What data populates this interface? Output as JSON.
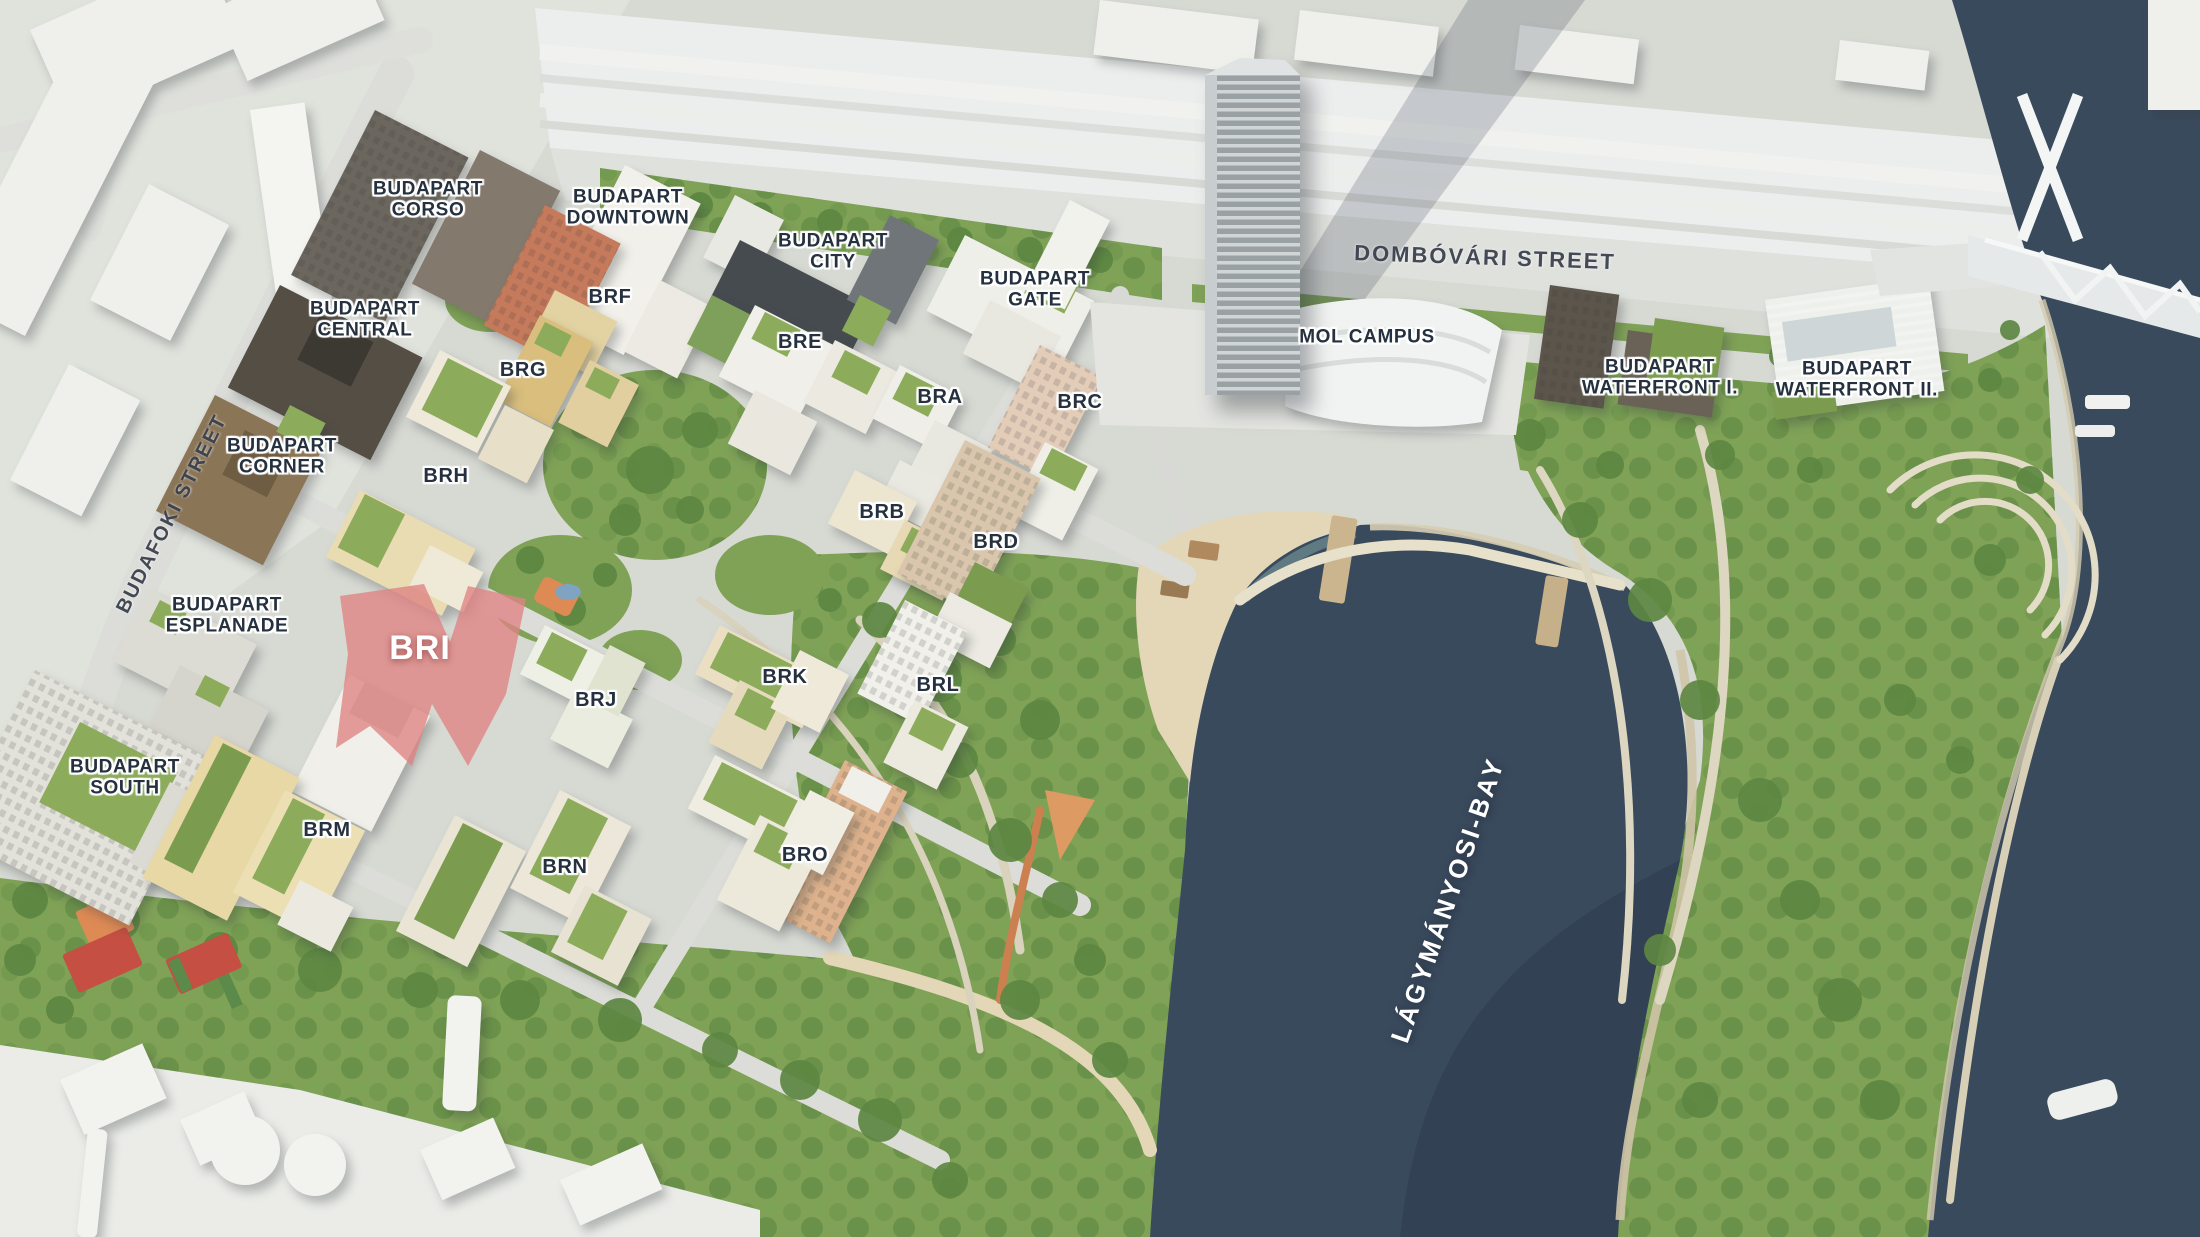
{
  "map_title": "BudaPart development aerial masterplan",
  "colors": {
    "water": "#3a4a5d",
    "water_deep": "#2d3b4c",
    "park": "#7fa257",
    "park_dark": "#557e3b",
    "land": "#d7d9d3",
    "white_zone": "#e7e8e4",
    "corridor": "#eceded",
    "road": "#dcddd9",
    "sand": "#e3d7b8",
    "roof_green": "#8cab5b",
    "ink": "#26313f",
    "label_outline": "#ffffff",
    "highlight": "#df8383",
    "court_red": "#c44f42",
    "court_orange": "#dd8a55"
  },
  "highlighted_building": {
    "code": "BRI",
    "highlight_color": "#df8383"
  },
  "labels": [
    {
      "id": "budapart-corso",
      "text": "BUDAPART\nCORSO",
      "x": 428,
      "y": 200,
      "style": "district"
    },
    {
      "id": "budapart-downtown",
      "text": "BUDAPART\nDOWNTOWN",
      "x": 628,
      "y": 208,
      "style": "district"
    },
    {
      "id": "budapart-city",
      "text": "BUDAPART\nCITY",
      "x": 833,
      "y": 252,
      "style": "district"
    },
    {
      "id": "budapart-gate",
      "text": "BUDAPART\nGATE",
      "x": 1035,
      "y": 290,
      "style": "district"
    },
    {
      "id": "budapart-central",
      "text": "BUDAPART\nCENTRAL",
      "x": 365,
      "y": 320,
      "style": "district"
    },
    {
      "id": "budapart-corner",
      "text": "BUDAPART\nCORNER",
      "x": 282,
      "y": 457,
      "style": "district"
    },
    {
      "id": "budapart-esplanade",
      "text": "BUDAPART\nESPLANADE",
      "x": 227,
      "y": 616,
      "style": "district"
    },
    {
      "id": "budapart-south",
      "text": "BUDAPART\nSOUTH",
      "x": 125,
      "y": 778,
      "style": "district"
    },
    {
      "id": "mol-campus",
      "text": "MOL CAMPUS",
      "x": 1367,
      "y": 337,
      "style": "district"
    },
    {
      "id": "budapart-waterfront-1",
      "text": "BUDAPART\nWATERFRONT I.",
      "x": 1660,
      "y": 378,
      "style": "district"
    },
    {
      "id": "budapart-waterfront-2",
      "text": "BUDAPART\nWATERFRONT II.",
      "x": 1857,
      "y": 380,
      "style": "district"
    },
    {
      "id": "brf",
      "text": "BRF",
      "x": 610,
      "y": 297,
      "style": "code"
    },
    {
      "id": "brg",
      "text": "BRG",
      "x": 523,
      "y": 370,
      "style": "code"
    },
    {
      "id": "bre",
      "text": "BRE",
      "x": 800,
      "y": 342,
      "style": "code"
    },
    {
      "id": "bra",
      "text": "BRA",
      "x": 940,
      "y": 397,
      "style": "code"
    },
    {
      "id": "brc",
      "text": "BRC",
      "x": 1080,
      "y": 402,
      "style": "code"
    },
    {
      "id": "brh",
      "text": "BRH",
      "x": 446,
      "y": 476,
      "style": "code"
    },
    {
      "id": "brb",
      "text": "BRB",
      "x": 882,
      "y": 512,
      "style": "code"
    },
    {
      "id": "brd",
      "text": "BRD",
      "x": 996,
      "y": 542,
      "style": "code"
    },
    {
      "id": "bri",
      "text": "BRI",
      "x": 420,
      "y": 648,
      "style": "highlight"
    },
    {
      "id": "brj",
      "text": "BRJ",
      "x": 596,
      "y": 700,
      "style": "code"
    },
    {
      "id": "brk",
      "text": "BRK",
      "x": 785,
      "y": 677,
      "style": "code"
    },
    {
      "id": "brl",
      "text": "BRL",
      "x": 938,
      "y": 685,
      "style": "code"
    },
    {
      "id": "brm",
      "text": "BRM",
      "x": 327,
      "y": 830,
      "style": "code"
    },
    {
      "id": "brn",
      "text": "BRN",
      "x": 565,
      "y": 867,
      "style": "code"
    },
    {
      "id": "bro",
      "text": "BRO",
      "x": 805,
      "y": 855,
      "style": "code"
    },
    {
      "id": "dombovari-street",
      "text": "DOMBÓVÁRI STREET",
      "x": 1485,
      "y": 258,
      "rotate": 2,
      "size": 22,
      "style": "street"
    },
    {
      "id": "budafoki-street",
      "text": "BUDAFOKI STREET",
      "x": 172,
      "y": 514,
      "rotate": -63,
      "size": 20,
      "style": "street"
    },
    {
      "id": "lagymanyosi-bay",
      "text": "LÁGYMÁNYOSI-BAY",
      "x": 1448,
      "y": 900,
      "rotate": -71,
      "style": "water"
    }
  ]
}
